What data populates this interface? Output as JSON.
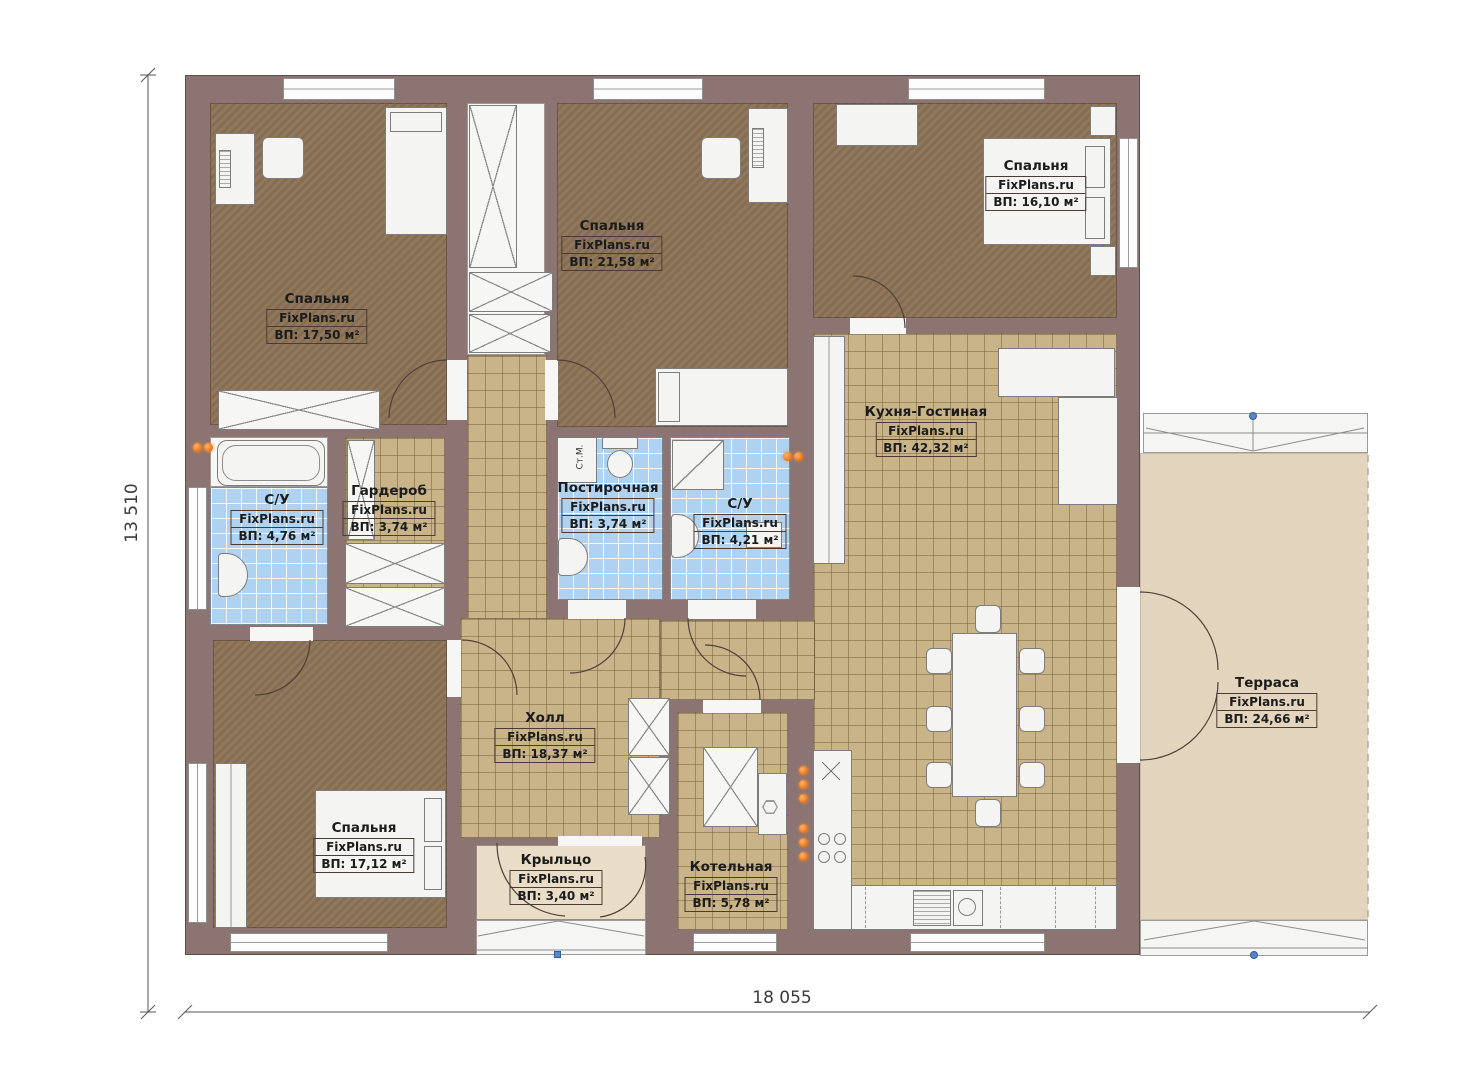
{
  "plan_title": "floor-plan",
  "dims": {
    "width": "18 055",
    "height": "13 510"
  },
  "rooms": [
    {
      "id": "bedroom-1",
      "name": "Спальня",
      "brand": "FixPlans.ru",
      "area": "ВП: 17,50 м²"
    },
    {
      "id": "bedroom-2",
      "name": "Спальня",
      "brand": "FixPlans.ru",
      "area": "ВП: 21,58 м²"
    },
    {
      "id": "bedroom-3",
      "name": "Спальня",
      "brand": "FixPlans.ru",
      "area": "ВП: 16,10 м²"
    },
    {
      "id": "bathroom-1",
      "name": "С/У",
      "brand": "FixPlans.ru",
      "area": "ВП: 4,76 м²"
    },
    {
      "id": "wardrobe",
      "name": "Гардероб",
      "brand": "FixPlans.ru",
      "area": "ВП: 3,74 м²"
    },
    {
      "id": "laundry",
      "name": "Постирочная",
      "brand": "FixPlans.ru",
      "area": "ВП: 3,74 м²"
    },
    {
      "id": "bathroom-2",
      "name": "С/У",
      "brand": "FixPlans.ru",
      "area": "ВП: 4,21 м²"
    },
    {
      "id": "kitchen-living",
      "name": "Кухня-Гостиная",
      "brand": "FixPlans.ru",
      "area": "ВП: 42,32 м²"
    },
    {
      "id": "hall",
      "name": "Холл",
      "brand": "FixPlans.ru",
      "area": "ВП: 18,37 м²"
    },
    {
      "id": "bedroom-4",
      "name": "Спальня",
      "brand": "FixPlans.ru",
      "area": "ВП: 17,12 м²"
    },
    {
      "id": "porch",
      "name": "Крыльцо",
      "brand": "FixPlans.ru",
      "area": "ВП: 3,40 м²"
    },
    {
      "id": "boiler",
      "name": "Котельная",
      "brand": "FixPlans.ru",
      "area": "ВП: 5,78 м²"
    },
    {
      "id": "terrace",
      "name": "Терраса",
      "brand": "FixPlans.ru",
      "area": "ВП: 24,66 м²"
    }
  ],
  "fixtures": {
    "washer_label": "Ст.М."
  },
  "colors": {
    "wall": "#8b7472",
    "bedroom_floor": "#8c7356",
    "tile_floor": "#c9b489",
    "bath_tile": "#aed2ef",
    "terrace_floor": "#e3d5bd",
    "radiator_orange": "#ef7d1f",
    "marker_blue": "#5b86c4"
  }
}
